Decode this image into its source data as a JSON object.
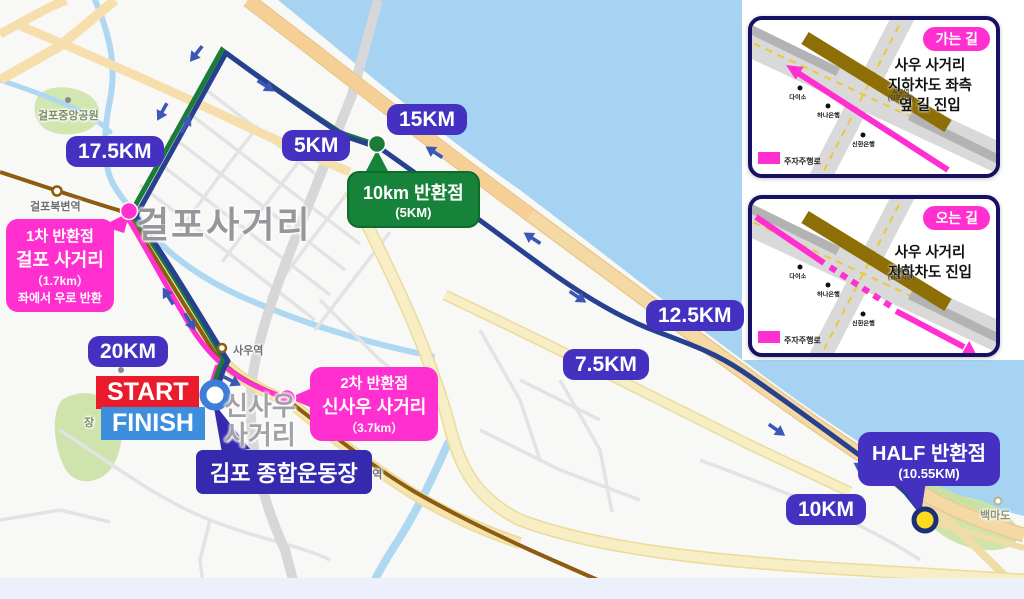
{
  "colors": {
    "badge_indigo": "#4531c1",
    "magenta": "#ff2fd0",
    "green_box": "#16823a",
    "stadium_navy": "#352aad",
    "start_red": "#ea1c2c",
    "finish_blue": "#3e8ede",
    "course_navy": "#27408f",
    "course_green": "#1a7c38",
    "course_pink": "#ff2fd0",
    "river_blue": "#a5d3f1"
  },
  "badges": {
    "b175": {
      "label": "17.5KM"
    },
    "b5": {
      "label": "5KM"
    },
    "b15": {
      "label": "15KM"
    },
    "b125": {
      "label": "12.5KM"
    },
    "b75": {
      "label": "7.5KM"
    },
    "b20": {
      "label": "20KM"
    },
    "b10": {
      "label": "10KM"
    }
  },
  "callouts": {
    "turn1": {
      "line1": "1차 반환점",
      "line2": "걸포 사거리",
      "line3": "（1.7km）",
      "line4": "좌에서 우로 반환"
    },
    "turn10k": {
      "line1": "10km 반환점",
      "line2": "(5KM)"
    },
    "turn2": {
      "line1": "2차 반환점",
      "line2": "신사우 사거리",
      "line3": "（3.7km）"
    },
    "half": {
      "line1": "HALF 반환점",
      "line2": "(10.55KM)"
    },
    "start": "START",
    "finish": "FINISH",
    "stadium": "김포 종합운동장"
  },
  "places": {
    "geolpo_big": "걸포사거리",
    "sinsau_line1": "신사우",
    "sinsau_line2": "사거리",
    "park": "걸포중앙공원",
    "jangneung": "장",
    "baekmado": "백마도"
  },
  "stations": {
    "geolpobukbyeon": "걸포북변역",
    "sau": "사우역",
    "pungmu": "풍무역"
  },
  "insets": {
    "going": {
      "title": "가는 길",
      "desc1": "사우 사거리",
      "desc2": "지하차도 좌측",
      "desc3": "옆 길 진입",
      "legend": "주자주행로",
      "poi1": "다이소",
      "poi2": "하나은행",
      "poi3": "신한은행",
      "station1": "사우역",
      "station2": "(김포시청)"
    },
    "coming": {
      "title": "오는 길",
      "desc1": "사우 사거리",
      "desc2": "지하차도 진입",
      "legend": "주자주행로",
      "poi1": "다이소",
      "poi2": "하나은행",
      "poi3": "신한은행",
      "station1": "사우역",
      "station2": "(김포시청)"
    }
  }
}
